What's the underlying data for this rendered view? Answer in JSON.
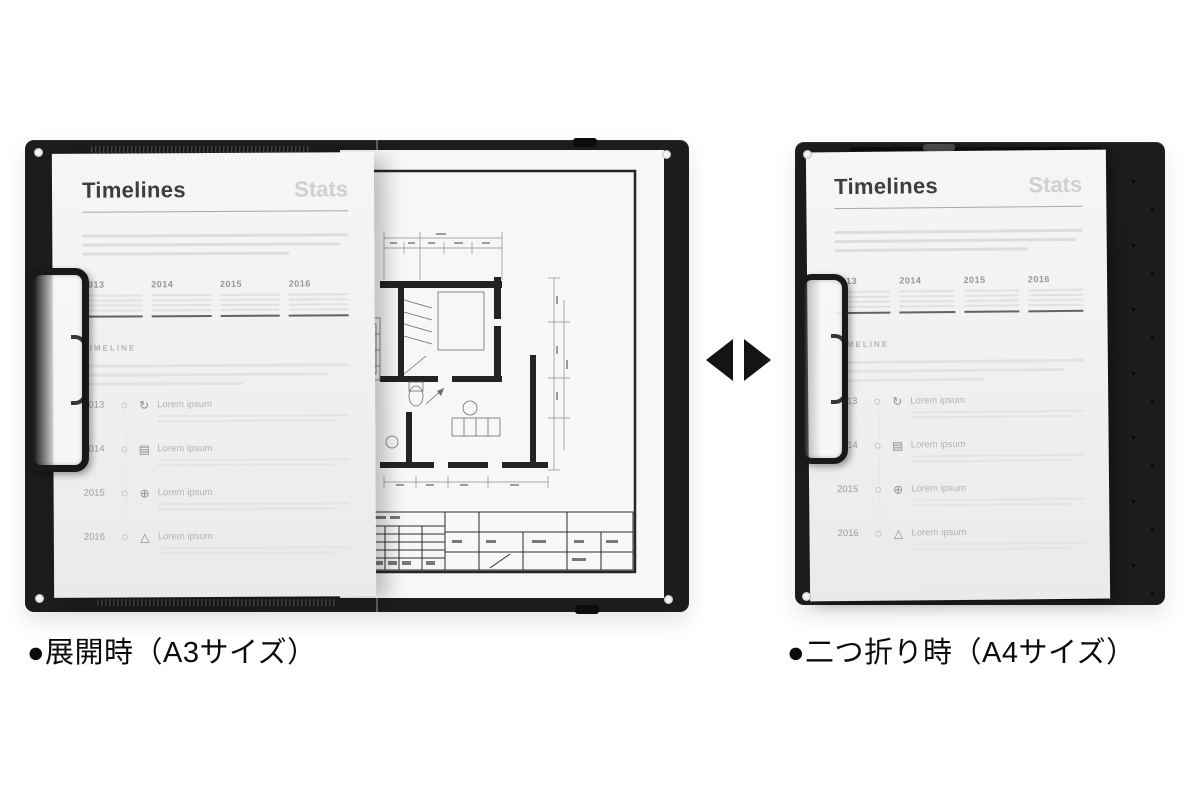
{
  "scene": {
    "left_caption": "●展開時（A3サイズ）",
    "right_caption": "●二つ折り時（A4サイズ）"
  },
  "document": {
    "title": "Timelines",
    "subtitle": "Stats",
    "years": [
      "2013",
      "2014",
      "2015",
      "2016"
    ],
    "section_label": "TIMELINE",
    "timeline": [
      {
        "year": "2013",
        "icon": "refresh-icon",
        "glyph": "↻",
        "label": "Lorem ipsum"
      },
      {
        "year": "2014",
        "icon": "presentation-icon",
        "glyph": "▤",
        "label": "Lorem ipsum"
      },
      {
        "year": "2015",
        "icon": "globe-icon",
        "glyph": "⊕",
        "label": "Lorem ipsum"
      },
      {
        "year": "2016",
        "icon": "marker-icon",
        "glyph": "△",
        "label": "Lorem ipsum"
      }
    ]
  },
  "colors": {
    "board_black": "#1b1c1d",
    "paper": "#f2f4f3",
    "title_dark": "#3b3e3d",
    "subtitle_gray": "#cdd1cf",
    "arrow_black": "#141414"
  }
}
